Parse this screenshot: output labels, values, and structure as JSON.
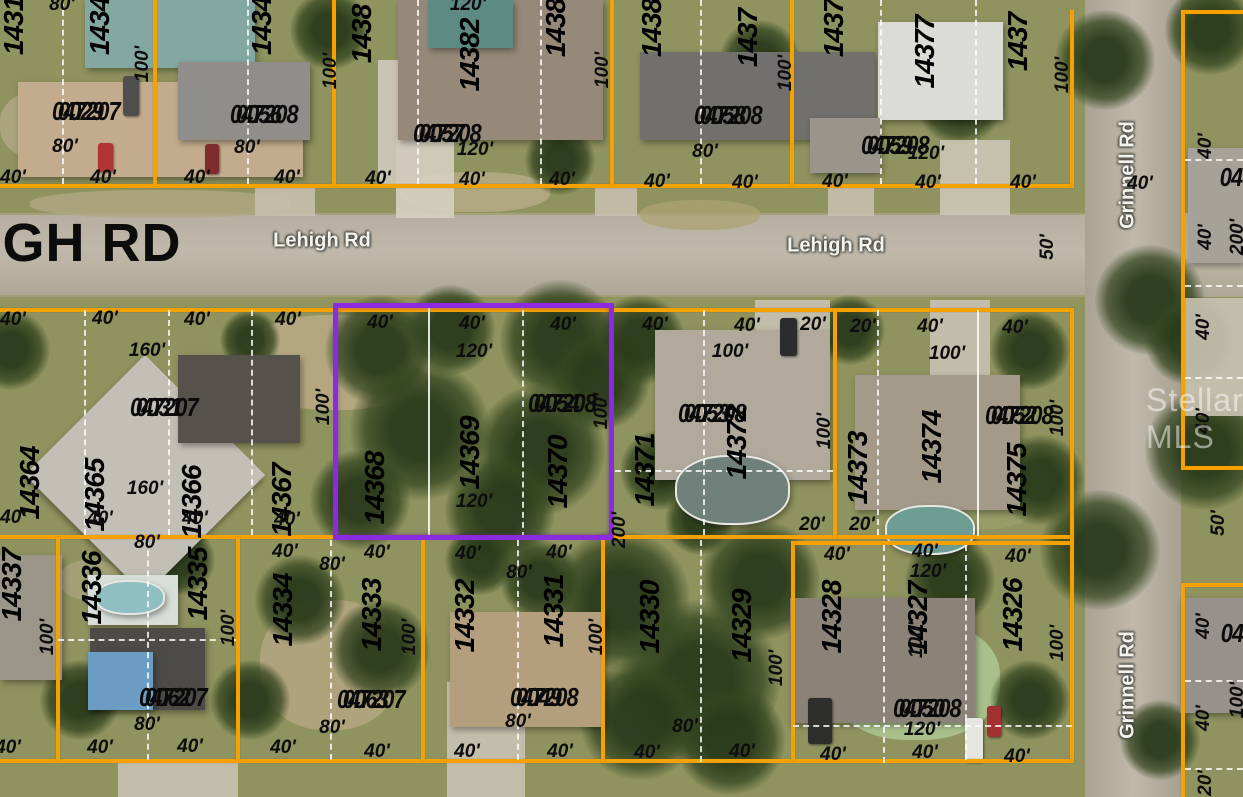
{
  "map": {
    "watermark": "Stellar MLS",
    "colors": {
      "parcel_line": "#f5a200",
      "highlight_line": "#8a2be0",
      "lot_line": "#ffffff",
      "label": "#0d0d0d"
    },
    "highlighted_parcel": {
      "id_line1": "047208",
      "id_line2": "0054",
      "lots": "14368 14369 14370"
    },
    "road_labels": [
      {
        "text": "GH RD",
        "x": 92,
        "y": 243,
        "kind": "big"
      },
      {
        "text": "Lehigh Rd",
        "x": 322,
        "y": 241,
        "kind": "white"
      },
      {
        "text": "Lehigh Rd",
        "x": 836,
        "y": 246,
        "kind": "white"
      },
      {
        "text": "Grinnell Rd",
        "x": 1128,
        "y": 175,
        "kind": "white",
        "rot": -90
      },
      {
        "text": "Grinnell Rd",
        "x": 1128,
        "y": 685,
        "kind": "white",
        "rot": -90
      }
    ],
    "parcel_ids": [
      {
        "line1": "047207",
        "line2": "0029",
        "x": 52,
        "y": 96
      },
      {
        "line1": "047208",
        "line2": "0056",
        "x": 230,
        "y": 99
      },
      {
        "line1": "047208",
        "line2": "0057",
        "x": 413,
        "y": 118
      },
      {
        "line1": "047208",
        "line2": "0058",
        "x": 694,
        "y": 100
      },
      {
        "line1": "047208",
        "line2": "0059",
        "x": 861,
        "y": 130
      },
      {
        "line1": "047207",
        "line2": "0031",
        "x": 130,
        "y": 392
      },
      {
        "line1": "047208",
        "line2": "0054",
        "x": 528,
        "y": 388
      },
      {
        "line1": "047208",
        "line2": "0053",
        "x": 678,
        "y": 398
      },
      {
        "line1": "047208",
        "line2": "0052",
        "x": 985,
        "y": 400
      },
      {
        "line1": "047207",
        "line2": "0062",
        "x": 139,
        "y": 682
      },
      {
        "line1": "047207",
        "line2": "0063",
        "x": 337,
        "y": 684
      },
      {
        "line1": "047208",
        "line2": "0049",
        "x": 510,
        "y": 682
      },
      {
        "line1": "047208",
        "line2": "0050",
        "x": 893,
        "y": 693
      }
    ],
    "partial_parcel_ids": [
      {
        "text": "04",
        "x": 1231,
        "y": 177
      },
      {
        "text": "04",
        "x": 1232,
        "y": 633
      }
    ],
    "lot_numbers": [
      {
        "text": "1431",
        "x": 14,
        "y": 26
      },
      {
        "text": "1434",
        "x": 100,
        "y": 26
      },
      {
        "text": "1434",
        "x": 262,
        "y": 26
      },
      {
        "text": "1438",
        "x": 362,
        "y": 34
      },
      {
        "text": "14382",
        "x": 470,
        "y": 55
      },
      {
        "text": "1438",
        "x": 556,
        "y": 28
      },
      {
        "text": "1438",
        "x": 652,
        "y": 28
      },
      {
        "text": "1437",
        "x": 748,
        "y": 38
      },
      {
        "text": "1437",
        "x": 834,
        "y": 28
      },
      {
        "text": "14377",
        "x": 925,
        "y": 52
      },
      {
        "text": "1437",
        "x": 1018,
        "y": 42
      },
      {
        "text": "14364",
        "x": 30,
        "y": 483
      },
      {
        "text": "14365",
        "x": 95,
        "y": 495
      },
      {
        "text": "14366",
        "x": 192,
        "y": 502
      },
      {
        "text": "14367",
        "x": 282,
        "y": 500
      },
      {
        "text": "14368",
        "x": 375,
        "y": 488
      },
      {
        "text": "14369",
        "x": 470,
        "y": 453
      },
      {
        "text": "14370",
        "x": 558,
        "y": 472
      },
      {
        "text": "14371",
        "x": 645,
        "y": 470
      },
      {
        "text": "14372",
        "x": 737,
        "y": 443
      },
      {
        "text": "14373",
        "x": 858,
        "y": 468
      },
      {
        "text": "14374",
        "x": 932,
        "y": 447
      },
      {
        "text": "14375",
        "x": 1017,
        "y": 480
      },
      {
        "text": "14337",
        "x": 12,
        "y": 585
      },
      {
        "text": "14336",
        "x": 92,
        "y": 588
      },
      {
        "text": "14335",
        "x": 198,
        "y": 584
      },
      {
        "text": "14334",
        "x": 283,
        "y": 610
      },
      {
        "text": "14333",
        "x": 372,
        "y": 615
      },
      {
        "text": "14332",
        "x": 465,
        "y": 616
      },
      {
        "text": "14331",
        "x": 554,
        "y": 611
      },
      {
        "text": "14330",
        "x": 650,
        "y": 617
      },
      {
        "text": "14329",
        "x": 742,
        "y": 626
      },
      {
        "text": "14328",
        "x": 832,
        "y": 617
      },
      {
        "text": "14327",
        "x": 918,
        "y": 618
      },
      {
        "text": "14326",
        "x": 1013,
        "y": 615
      }
    ],
    "dimensions": [
      {
        "t": "80'",
        "x": 62,
        "y": 5
      },
      {
        "t": "120'",
        "x": 468,
        "y": 5
      },
      {
        "t": "100'",
        "x": 143,
        "y": 64,
        "r": 1
      },
      {
        "t": "100'",
        "x": 331,
        "y": 71,
        "r": 1
      },
      {
        "t": "100'",
        "x": 603,
        "y": 70,
        "r": 1
      },
      {
        "t": "100'",
        "x": 786,
        "y": 73,
        "r": 1
      },
      {
        "t": "100'",
        "x": 1063,
        "y": 75,
        "r": 1
      },
      {
        "t": "80'",
        "x": 65,
        "y": 147
      },
      {
        "t": "80'",
        "x": 247,
        "y": 148
      },
      {
        "t": "120'",
        "x": 475,
        "y": 150
      },
      {
        "t": "80'",
        "x": 705,
        "y": 152
      },
      {
        "t": "120'",
        "x": 926,
        "y": 154
      },
      {
        "t": "40'",
        "x": 13,
        "y": 178
      },
      {
        "t": "40'",
        "x": 103,
        "y": 178
      },
      {
        "t": "40'",
        "x": 197,
        "y": 178
      },
      {
        "t": "40'",
        "x": 287,
        "y": 178
      },
      {
        "t": "40'",
        "x": 378,
        "y": 179
      },
      {
        "t": "40'",
        "x": 472,
        "y": 180
      },
      {
        "t": "40'",
        "x": 562,
        "y": 180
      },
      {
        "t": "40'",
        "x": 657,
        "y": 182
      },
      {
        "t": "40'",
        "x": 745,
        "y": 183
      },
      {
        "t": "40'",
        "x": 835,
        "y": 182
      },
      {
        "t": "40'",
        "x": 928,
        "y": 183
      },
      {
        "t": "40'",
        "x": 1023,
        "y": 183
      },
      {
        "t": "40'",
        "x": 1140,
        "y": 184
      },
      {
        "t": "50'",
        "x": 1048,
        "y": 247,
        "r": 1
      },
      {
        "t": "40'",
        "x": 1206,
        "y": 146,
        "r": 1
      },
      {
        "t": "40'",
        "x": 1206,
        "y": 237,
        "r": 1
      },
      {
        "t": "200'",
        "x": 1238,
        "y": 237,
        "r": 1
      },
      {
        "t": "40'",
        "x": 1204,
        "y": 327,
        "r": 1
      },
      {
        "t": "40'",
        "x": 1204,
        "y": 421,
        "r": 1
      },
      {
        "t": "50'",
        "x": 1219,
        "y": 523,
        "r": 1
      },
      {
        "t": "40'",
        "x": 1204,
        "y": 626,
        "r": 1
      },
      {
        "t": "100'",
        "x": 1238,
        "y": 700,
        "r": 1
      },
      {
        "t": "40'",
        "x": 1204,
        "y": 718,
        "r": 1
      },
      {
        "t": "20'",
        "x": 1206,
        "y": 783,
        "r": 1
      },
      {
        "t": "40'",
        "x": 13,
        "y": 320
      },
      {
        "t": "40'",
        "x": 105,
        "y": 319
      },
      {
        "t": "40'",
        "x": 197,
        "y": 320
      },
      {
        "t": "40'",
        "x": 288,
        "y": 320
      },
      {
        "t": "40'",
        "x": 380,
        "y": 323
      },
      {
        "t": "40'",
        "x": 472,
        "y": 324
      },
      {
        "t": "40'",
        "x": 563,
        "y": 325
      },
      {
        "t": "40'",
        "x": 655,
        "y": 325
      },
      {
        "t": "40'",
        "x": 747,
        "y": 326
      },
      {
        "t": "20'",
        "x": 813,
        "y": 325
      },
      {
        "t": "20'",
        "x": 863,
        "y": 327
      },
      {
        "t": "40'",
        "x": 930,
        "y": 327
      },
      {
        "t": "40'",
        "x": 1015,
        "y": 328
      },
      {
        "t": "160'",
        "x": 147,
        "y": 351
      },
      {
        "t": "120'",
        "x": 474,
        "y": 352
      },
      {
        "t": "100'",
        "x": 730,
        "y": 352
      },
      {
        "t": "100'",
        "x": 947,
        "y": 354
      },
      {
        "t": "100'",
        "x": 324,
        "y": 407,
        "r": 1
      },
      {
        "t": "100'",
        "x": 602,
        "y": 411,
        "r": 1
      },
      {
        "t": "100'",
        "x": 825,
        "y": 431,
        "r": 1
      },
      {
        "t": "100'",
        "x": 1058,
        "y": 418,
        "r": 1
      },
      {
        "t": "160'",
        "x": 145,
        "y": 489
      },
      {
        "t": "120'",
        "x": 474,
        "y": 502
      },
      {
        "t": "40'",
        "x": 13,
        "y": 518
      },
      {
        "t": "40'",
        "x": 100,
        "y": 519
      },
      {
        "t": "40'",
        "x": 195,
        "y": 519
      },
      {
        "t": "40'",
        "x": 287,
        "y": 520
      },
      {
        "t": "20'",
        "x": 812,
        "y": 525
      },
      {
        "t": "20'",
        "x": 862,
        "y": 525
      },
      {
        "t": "200'",
        "x": 620,
        "y": 530,
        "r": 1
      },
      {
        "t": "40'",
        "x": 285,
        "y": 552
      },
      {
        "t": "40'",
        "x": 377,
        "y": 553
      },
      {
        "t": "40'",
        "x": 468,
        "y": 554
      },
      {
        "t": "40'",
        "x": 559,
        "y": 553
      },
      {
        "t": "40'",
        "x": 837,
        "y": 555
      },
      {
        "t": "40'",
        "x": 925,
        "y": 552
      },
      {
        "t": "40'",
        "x": 1018,
        "y": 557
      },
      {
        "t": "80'",
        "x": 147,
        "y": 543
      },
      {
        "t": "80'",
        "x": 332,
        "y": 565
      },
      {
        "t": "80'",
        "x": 519,
        "y": 573
      },
      {
        "t": "120'",
        "x": 928,
        "y": 572
      },
      {
        "t": "100'",
        "x": 48,
        "y": 637,
        "r": 1
      },
      {
        "t": "100'",
        "x": 229,
        "y": 628,
        "r": 1
      },
      {
        "t": "100'",
        "x": 410,
        "y": 637,
        "r": 1
      },
      {
        "t": "100'",
        "x": 597,
        "y": 637,
        "r": 1
      },
      {
        "t": "100'",
        "x": 777,
        "y": 668,
        "r": 1
      },
      {
        "t": "100'",
        "x": 917,
        "y": 640,
        "r": 1
      },
      {
        "t": "100'",
        "x": 1058,
        "y": 643,
        "r": 1
      },
      {
        "t": "80'",
        "x": 147,
        "y": 725
      },
      {
        "t": "80'",
        "x": 332,
        "y": 728
      },
      {
        "t": "80'",
        "x": 518,
        "y": 722
      },
      {
        "t": "80'",
        "x": 685,
        "y": 727
      },
      {
        "t": "120'",
        "x": 922,
        "y": 730
      },
      {
        "t": "40'",
        "x": 8,
        "y": 748
      },
      {
        "t": "40'",
        "x": 100,
        "y": 748
      },
      {
        "t": "40'",
        "x": 190,
        "y": 747
      },
      {
        "t": "40'",
        "x": 283,
        "y": 748
      },
      {
        "t": "40'",
        "x": 377,
        "y": 752
      },
      {
        "t": "40'",
        "x": 467,
        "y": 752
      },
      {
        "t": "40'",
        "x": 560,
        "y": 752
      },
      {
        "t": "40'",
        "x": 647,
        "y": 753
      },
      {
        "t": "40'",
        "x": 742,
        "y": 752
      },
      {
        "t": "40'",
        "x": 833,
        "y": 755
      },
      {
        "t": "40'",
        "x": 925,
        "y": 753
      },
      {
        "t": "40'",
        "x": 1017,
        "y": 757
      }
    ]
  }
}
